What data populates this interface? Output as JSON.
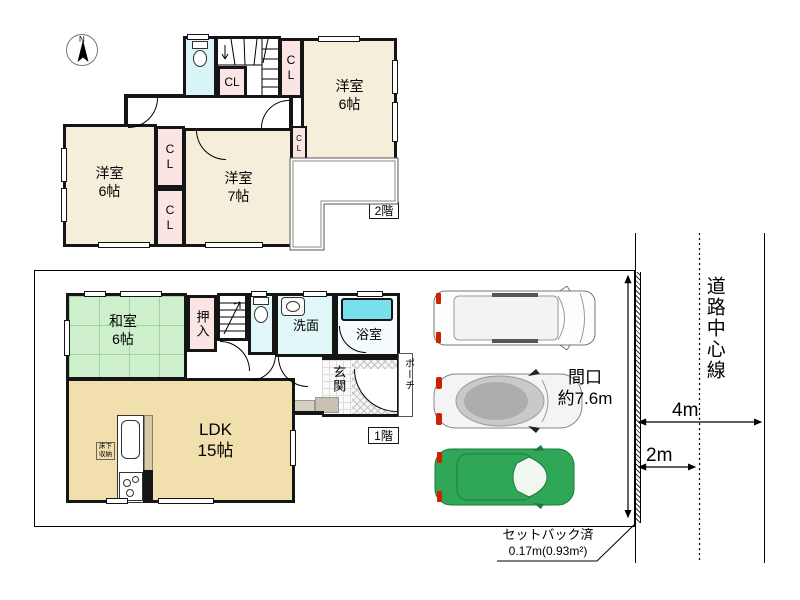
{
  "compass": {
    "north": "N"
  },
  "floor2": {
    "badge": "2階",
    "room_tr_name": "洋室",
    "room_tr_size": "6帖",
    "room_bl_name": "洋室",
    "room_bl_size": "6帖",
    "room_c_name": "洋室",
    "room_c_size": "7帖",
    "closet": "CL",
    "balcony": "バルコニー"
  },
  "floor1": {
    "badge": "1階",
    "washitsu_name": "和室",
    "washitsu_size": "6帖",
    "ldk_name": "LDK",
    "ldk_size": "15帖",
    "oshiire": "押入",
    "senmen": "洗面",
    "bath": "浴室",
    "genkan": "玄関",
    "porch": "ポーチ",
    "underfloor_l1": "床下",
    "underfloor_l2": "収納"
  },
  "site": {
    "frontage_label": "間口",
    "frontage_value": "約7.6m",
    "road_center_line": "道路中心線",
    "dim_road_full": "4m",
    "dim_road_half": "2m",
    "setback_label": "セットバック済",
    "setback_value": "0.17m(0.93m²)"
  },
  "colors": {
    "western_room": "#F5EEDA",
    "ldk": "#F2DFAE",
    "tatami_green": "#CDEFCB",
    "closet_pink": "#FAE4E4",
    "water_cyan": "#DFF5F7",
    "toilet_cyan": "#D8F4F6",
    "bathtub_cyan": "#79DFEA",
    "car_green": "#2FA757",
    "accent_red": "#CC2200"
  }
}
